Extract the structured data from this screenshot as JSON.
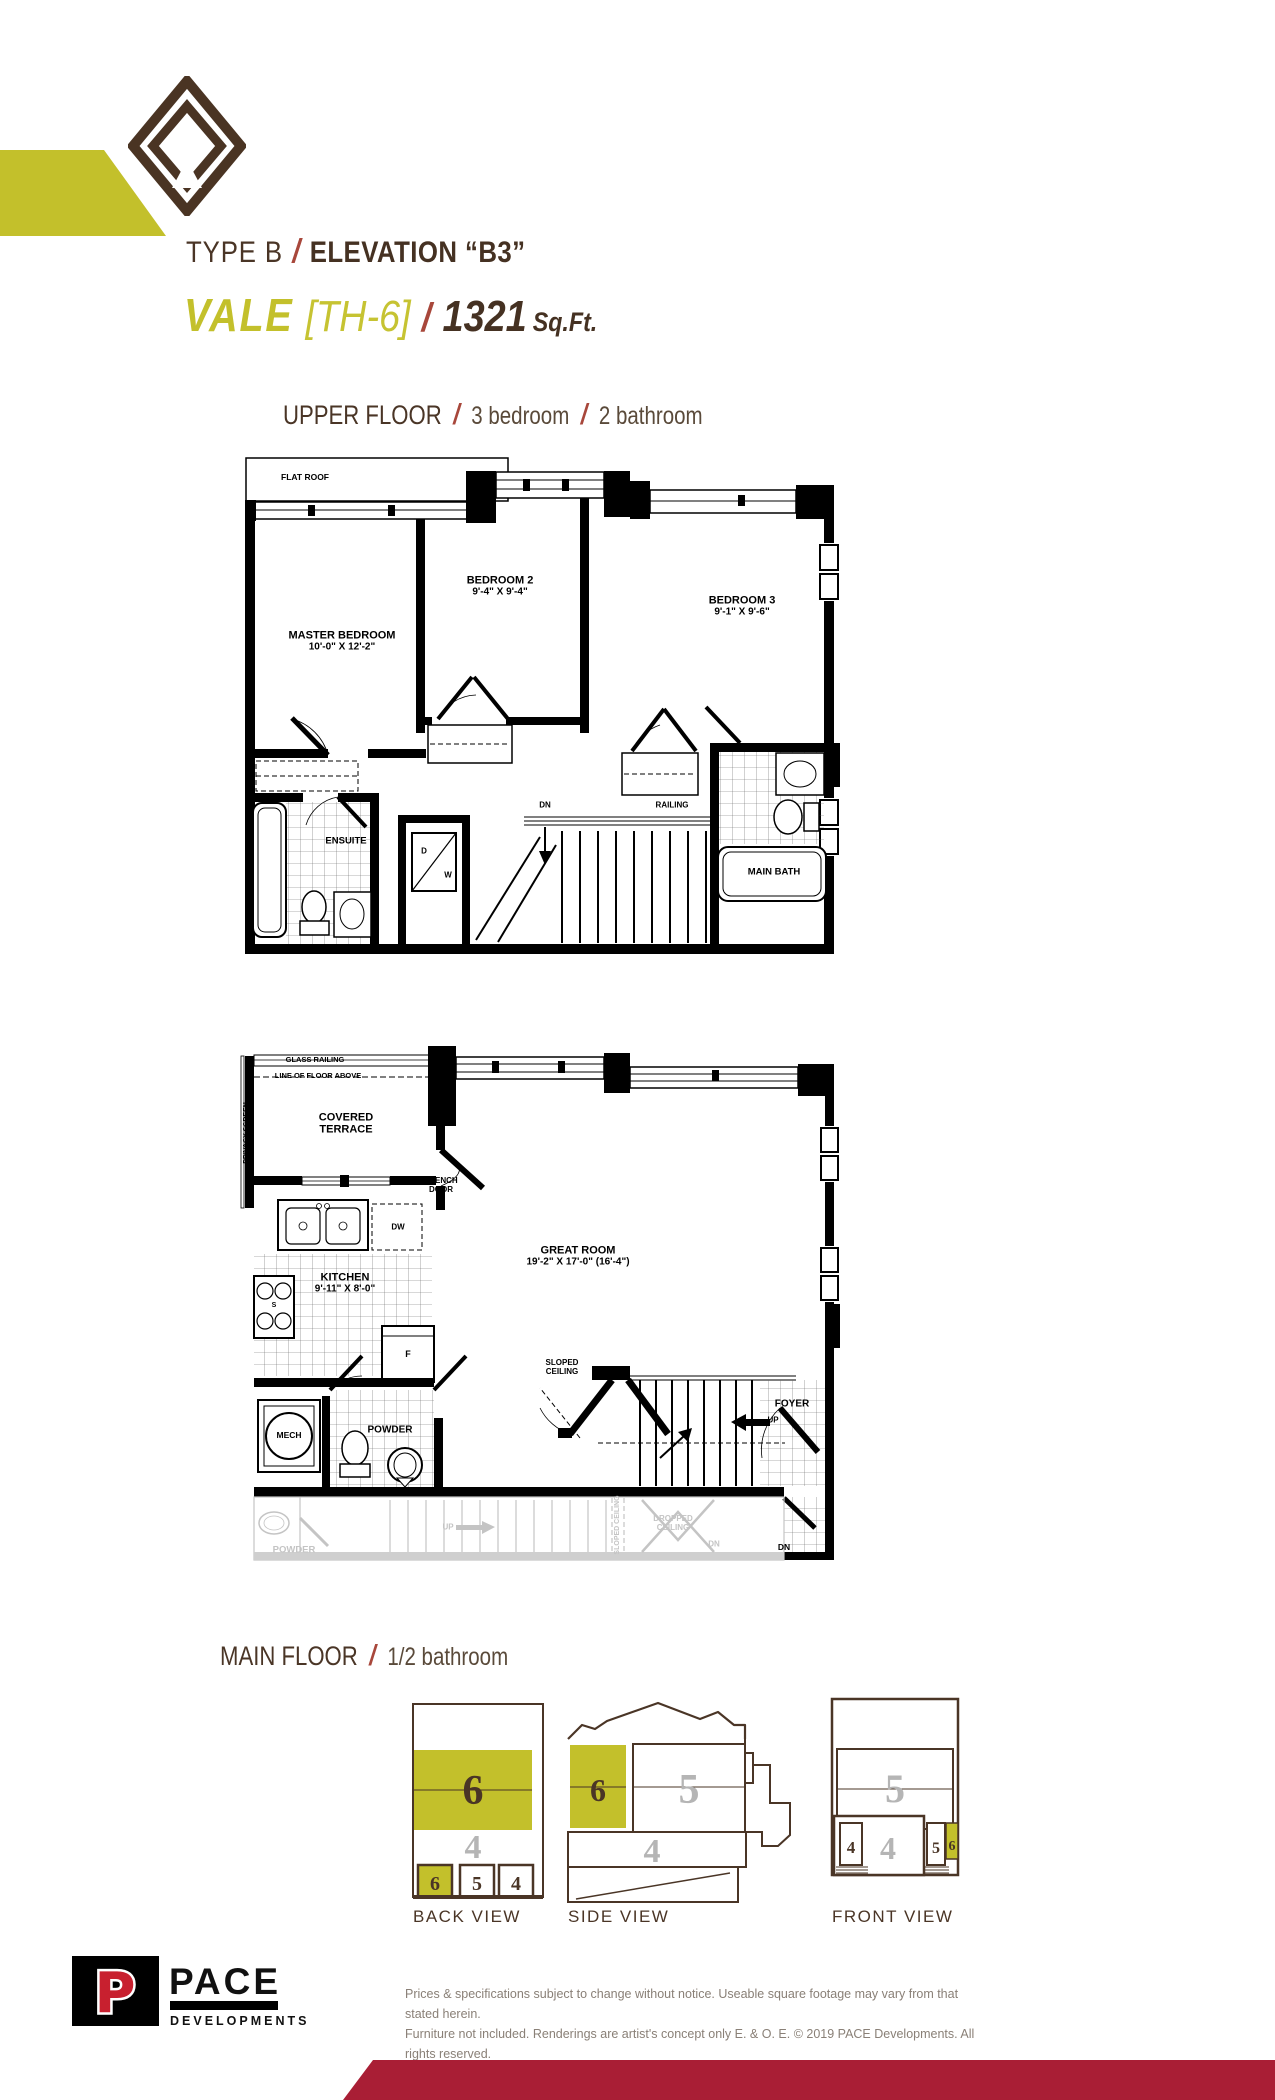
{
  "header": {
    "type_label": "TYPE B",
    "slash": "/",
    "elevation_label": "ELEVATION “B3”",
    "model_name": "VALE",
    "unit": "[TH-6]",
    "sqft_value": "1321",
    "sqft_unit": "Sq.Ft."
  },
  "upper_floor": {
    "heading": "UPPER FLOOR",
    "bedrooms": "3 bedroom",
    "bathrooms": "2 bathroom",
    "labels": {
      "flat_roof": "FLAT ROOF",
      "master_bedroom": "MASTER BEDROOM",
      "master_dims": "10'-0\" X 12'-2\"",
      "bedroom2": "BEDROOM 2",
      "bedroom2_dims": "9'-4\" X 9'-4\"",
      "bedroom3": "BEDROOM 3",
      "bedroom3_dims": "9'-1\" X 9'-6\"",
      "ensuite": "ENSUITE",
      "main_bath": "MAIN BATH",
      "dn": "DN",
      "railing": "RAILING",
      "dryer": "D",
      "washer": "W"
    }
  },
  "main_floor": {
    "heading": "MAIN FLOOR",
    "bathrooms": "1/2 bathroom",
    "labels": {
      "glass_railing": "GLASS RAILING",
      "line_of_floor_above": "LINE OF FLOOR ABOVE",
      "privacy_screen": "PRIVACY SCREEN",
      "covered_terrace": "COVERED TERRACE",
      "french_door": "FRENCH DOOR",
      "dishwasher": "DW",
      "kitchen": "KITCHEN",
      "kitchen_dims": "9'-11\" X 8'-0\"",
      "great_room": "GREAT ROOM",
      "great_room_dims": "19'-2\" X 17'-0\" (16'-4\")",
      "fridge": "F",
      "stove": "S",
      "mech": "MECH",
      "powder": "POWDER",
      "sloped_ceiling": "SLOPED CEILING",
      "foyer": "FOYER",
      "up": "UP",
      "dn": "DN"
    },
    "ghost_labels": {
      "powder": "POWDER",
      "up": "UP",
      "sloped_ceiling": "SLOPED CEILING",
      "dropped_ceiling": "DROPPED CEILING",
      "dn": "DN"
    }
  },
  "views": {
    "back": {
      "label": "BACK VIEW",
      "band6": "6",
      "band4": "4",
      "sq6": "6",
      "sq5": "5",
      "sq4": "4"
    },
    "side": {
      "label": "SIDE VIEW",
      "n6": "6",
      "n5": "5",
      "n4": "4"
    },
    "front": {
      "label": "FRONT VIEW",
      "n5": "5",
      "n4": "4",
      "door4": "4",
      "door5": "5",
      "door6": "6"
    }
  },
  "footer": {
    "logo_p": "P",
    "logo_name": "PACE",
    "logo_sub": "DEVELOPMENTS",
    "disclaimer_1": "Prices & specifications subject to change without notice. Useable square footage may vary from that stated herein.",
    "disclaimer_2": "Furniture not included. Renderings are artist's concept only E. & O. E. © 2019 PACE Developments. All rights reserved."
  },
  "colors": {
    "brand_brown": "#4a3526",
    "accent_olive": "#c3c02b",
    "accent_red": "#a8473b",
    "footer_band_red": "#a91e35",
    "ghost_gray": "#c4c4c4",
    "number_gray": "#b5b5b5"
  }
}
